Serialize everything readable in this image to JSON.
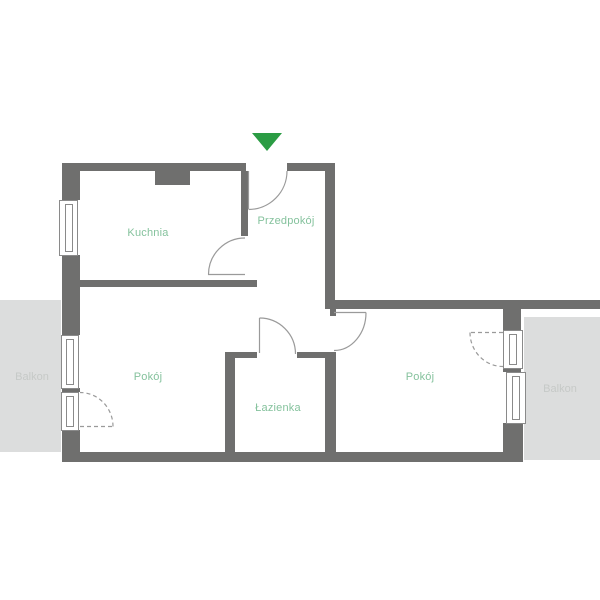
{
  "floorplan": {
    "rooms": {
      "kitchen": {
        "label": "Kuchnia"
      },
      "hallway": {
        "label": "Przedpokój"
      },
      "room_left": {
        "label": "Pokój"
      },
      "bathroom": {
        "label": "Łazienka"
      },
      "room_right": {
        "label": "Pokój"
      }
    },
    "balconies": {
      "left": {
        "label": "Balkon"
      },
      "right": {
        "label": "Balkon"
      }
    },
    "entrance": {
      "icon": "entrance-arrow",
      "direction": "down"
    }
  },
  "colors": {
    "wall": "#6f6f6e",
    "room_label": "#85c29d",
    "balcony_bg": "#dcdddd",
    "balcony_label": "#c6c9c7",
    "entrance_arrow": "#2b9c44",
    "door_line": "#9a9a9a",
    "window_frame_line": "#8a8a8a",
    "background": "#ffffff"
  }
}
